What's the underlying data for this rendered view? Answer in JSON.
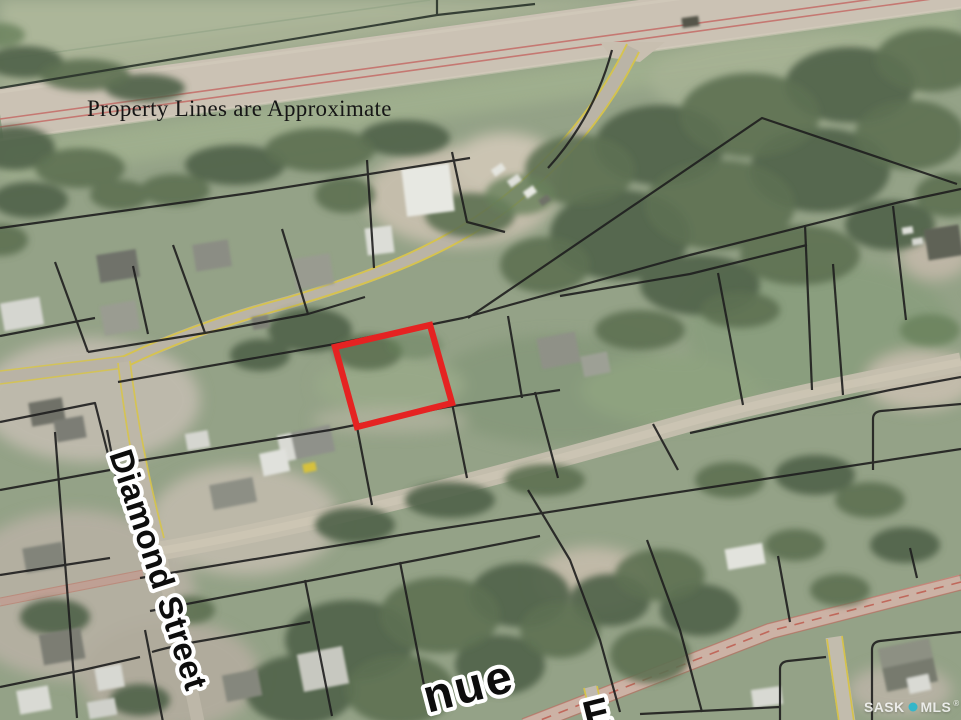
{
  "disclaimer": "Property Lines are Approximate",
  "street_labels": {
    "diamond": "Diamond Street",
    "avenue_partial": "nue",
    "cross_street_partial": "E"
  },
  "watermark": {
    "left": "SASK",
    "right": "MLS",
    "registered": "®"
  },
  "colors": {
    "parcel_outline": "#e52322",
    "property_line": "#1e1e1e",
    "road_edge_yellow": "#d7c44a",
    "highway_line_red": "#c4706a",
    "watermark_dot_teal": "#35b6c9",
    "label_text": "#0d0d0d",
    "label_halo": "#ffffff"
  }
}
